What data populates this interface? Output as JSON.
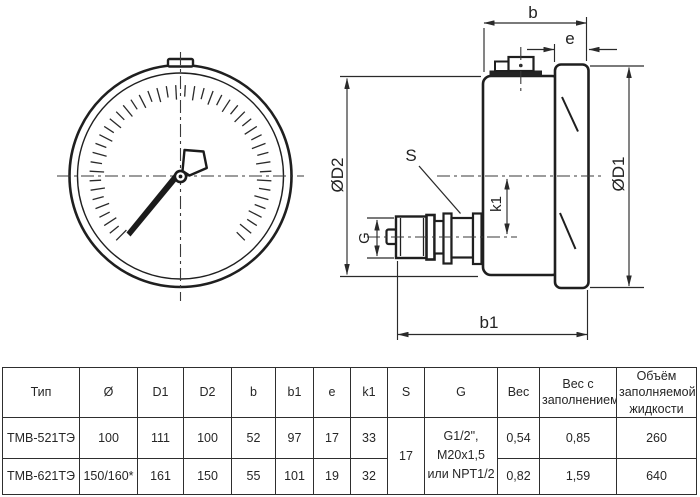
{
  "drawing": {
    "labels": {
      "b": "b",
      "e": "e",
      "od2": "ØD2",
      "od1": "ØD1",
      "s": "S",
      "k1": "k1",
      "g": "G",
      "b1": "b1"
    },
    "line_color": "#1f1f1f",
    "dim_color": "#2a2a2a"
  },
  "table": {
    "headers": [
      "Тип",
      "Ø",
      "D1",
      "D2",
      "b",
      "b1",
      "e",
      "k1",
      "S",
      "G",
      "Вес",
      "Вес с\nзаполнением",
      "Объём\nзаполняемой\nжидкости"
    ],
    "rows": [
      {
        "type": "ТМВ-521ТЭ",
        "diameter": "100",
        "d1": "111",
        "d2": "100",
        "b": "52",
        "b1": "97",
        "e": "17",
        "k1": "33",
        "s": "17",
        "g": "G1/2\",\nM20x1,5\nили NPT1/2",
        "weight": "0,54",
        "weight_filled": "0,85",
        "volume": "260"
      },
      {
        "type": "ТМВ-621ТЭ",
        "diameter": "150/160*",
        "d1": "161",
        "d2": "150",
        "b": "55",
        "b1": "101",
        "e": "19",
        "k1": "32",
        "weight": "0,82",
        "weight_filled": "1,59",
        "volume": "640"
      }
    ]
  }
}
